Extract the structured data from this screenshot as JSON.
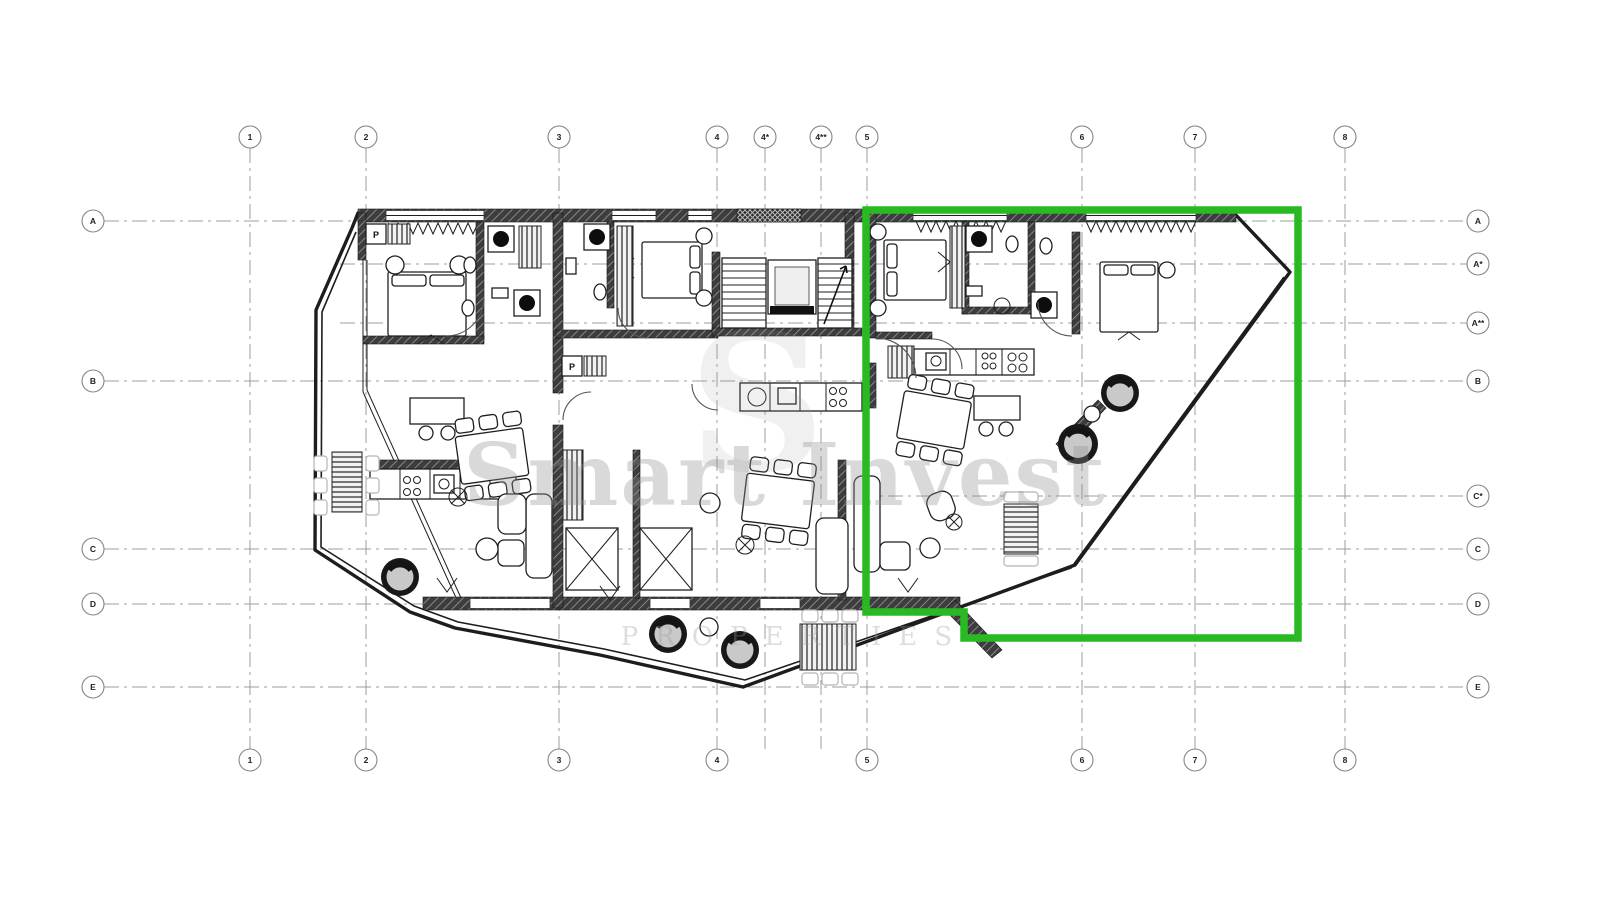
{
  "grid": {
    "bubble_radius": 11,
    "top_bubble_y": 137,
    "bottom_bubble_y": 760,
    "left_bubble_x": 93,
    "right_bubble_x": 1478,
    "v_line": {
      "y1": 148,
      "y2": 749
    },
    "h_line": {
      "x1": 104,
      "x2": 1467
    },
    "columns": [
      {
        "label": "1",
        "x": 250
      },
      {
        "label": "2",
        "x": 366
      },
      {
        "label": "3",
        "x": 559
      },
      {
        "label": "4",
        "x": 717
      },
      {
        "label": "4*",
        "x": 765,
        "bottom": false
      },
      {
        "label": "4**",
        "x": 821,
        "bottom": false
      },
      {
        "label": "5",
        "x": 867
      },
      {
        "label": "6",
        "x": 1082
      },
      {
        "label": "7",
        "x": 1195
      },
      {
        "label": "8",
        "x": 1345
      }
    ],
    "rows": [
      {
        "label": "A",
        "y": 221
      },
      {
        "label": "A*",
        "y": 264,
        "left": false,
        "x1": 340
      },
      {
        "label": "A**",
        "y": 323,
        "left": false,
        "x1": 340
      },
      {
        "label": "B",
        "y": 381
      },
      {
        "label": "C*",
        "y": 496,
        "left": false,
        "x1": 860
      },
      {
        "label": "C",
        "y": 549
      },
      {
        "label": "D",
        "y": 604
      },
      {
        "label": "E",
        "y": 687
      }
    ]
  },
  "watermark": {
    "monogram": "S",
    "line1": "Smart Invest",
    "line2": "PROPERTIES"
  },
  "highlight": {
    "color": "#28b923",
    "stroke_width": 7.5,
    "points": "866,210 1298,210 1298,638 964,638 964,612 866,612"
  },
  "labels": {
    "laundry": "P"
  }
}
